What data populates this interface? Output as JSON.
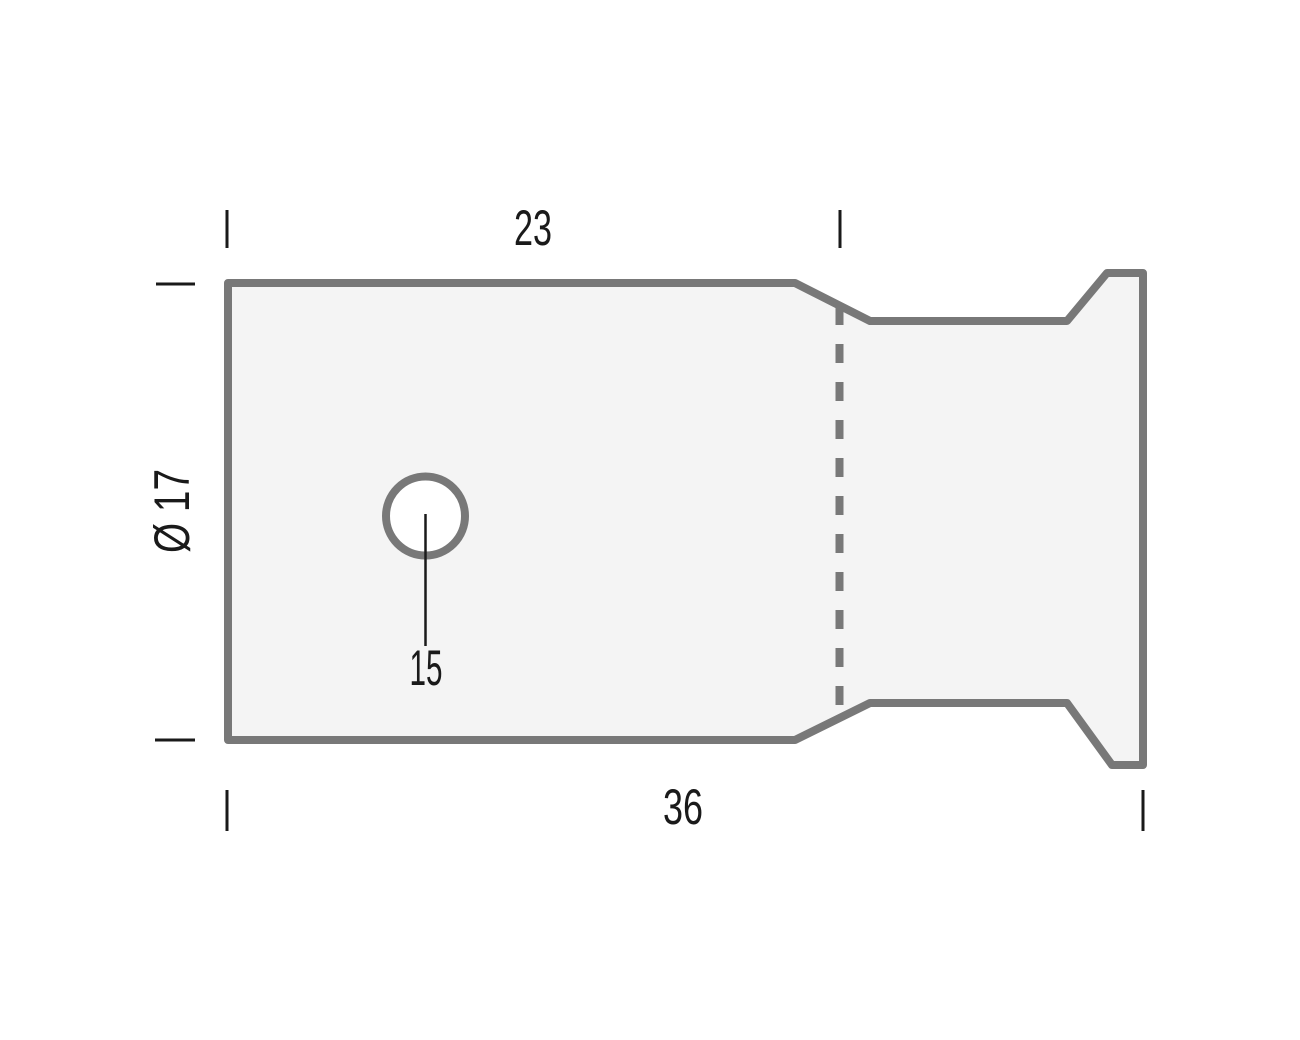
{
  "drawing": {
    "kind": "technical-dimension-drawing",
    "labels": {
      "top_length": "23",
      "overall_length": "36",
      "hole": "15",
      "diameter": "Ø 17"
    },
    "colors": {
      "background": "#ffffff",
      "part_fill": "#f4f4f4",
      "part_outline": "#787878",
      "dimension": "#1a1a1a",
      "hole_fill": "#ffffff"
    }
  }
}
